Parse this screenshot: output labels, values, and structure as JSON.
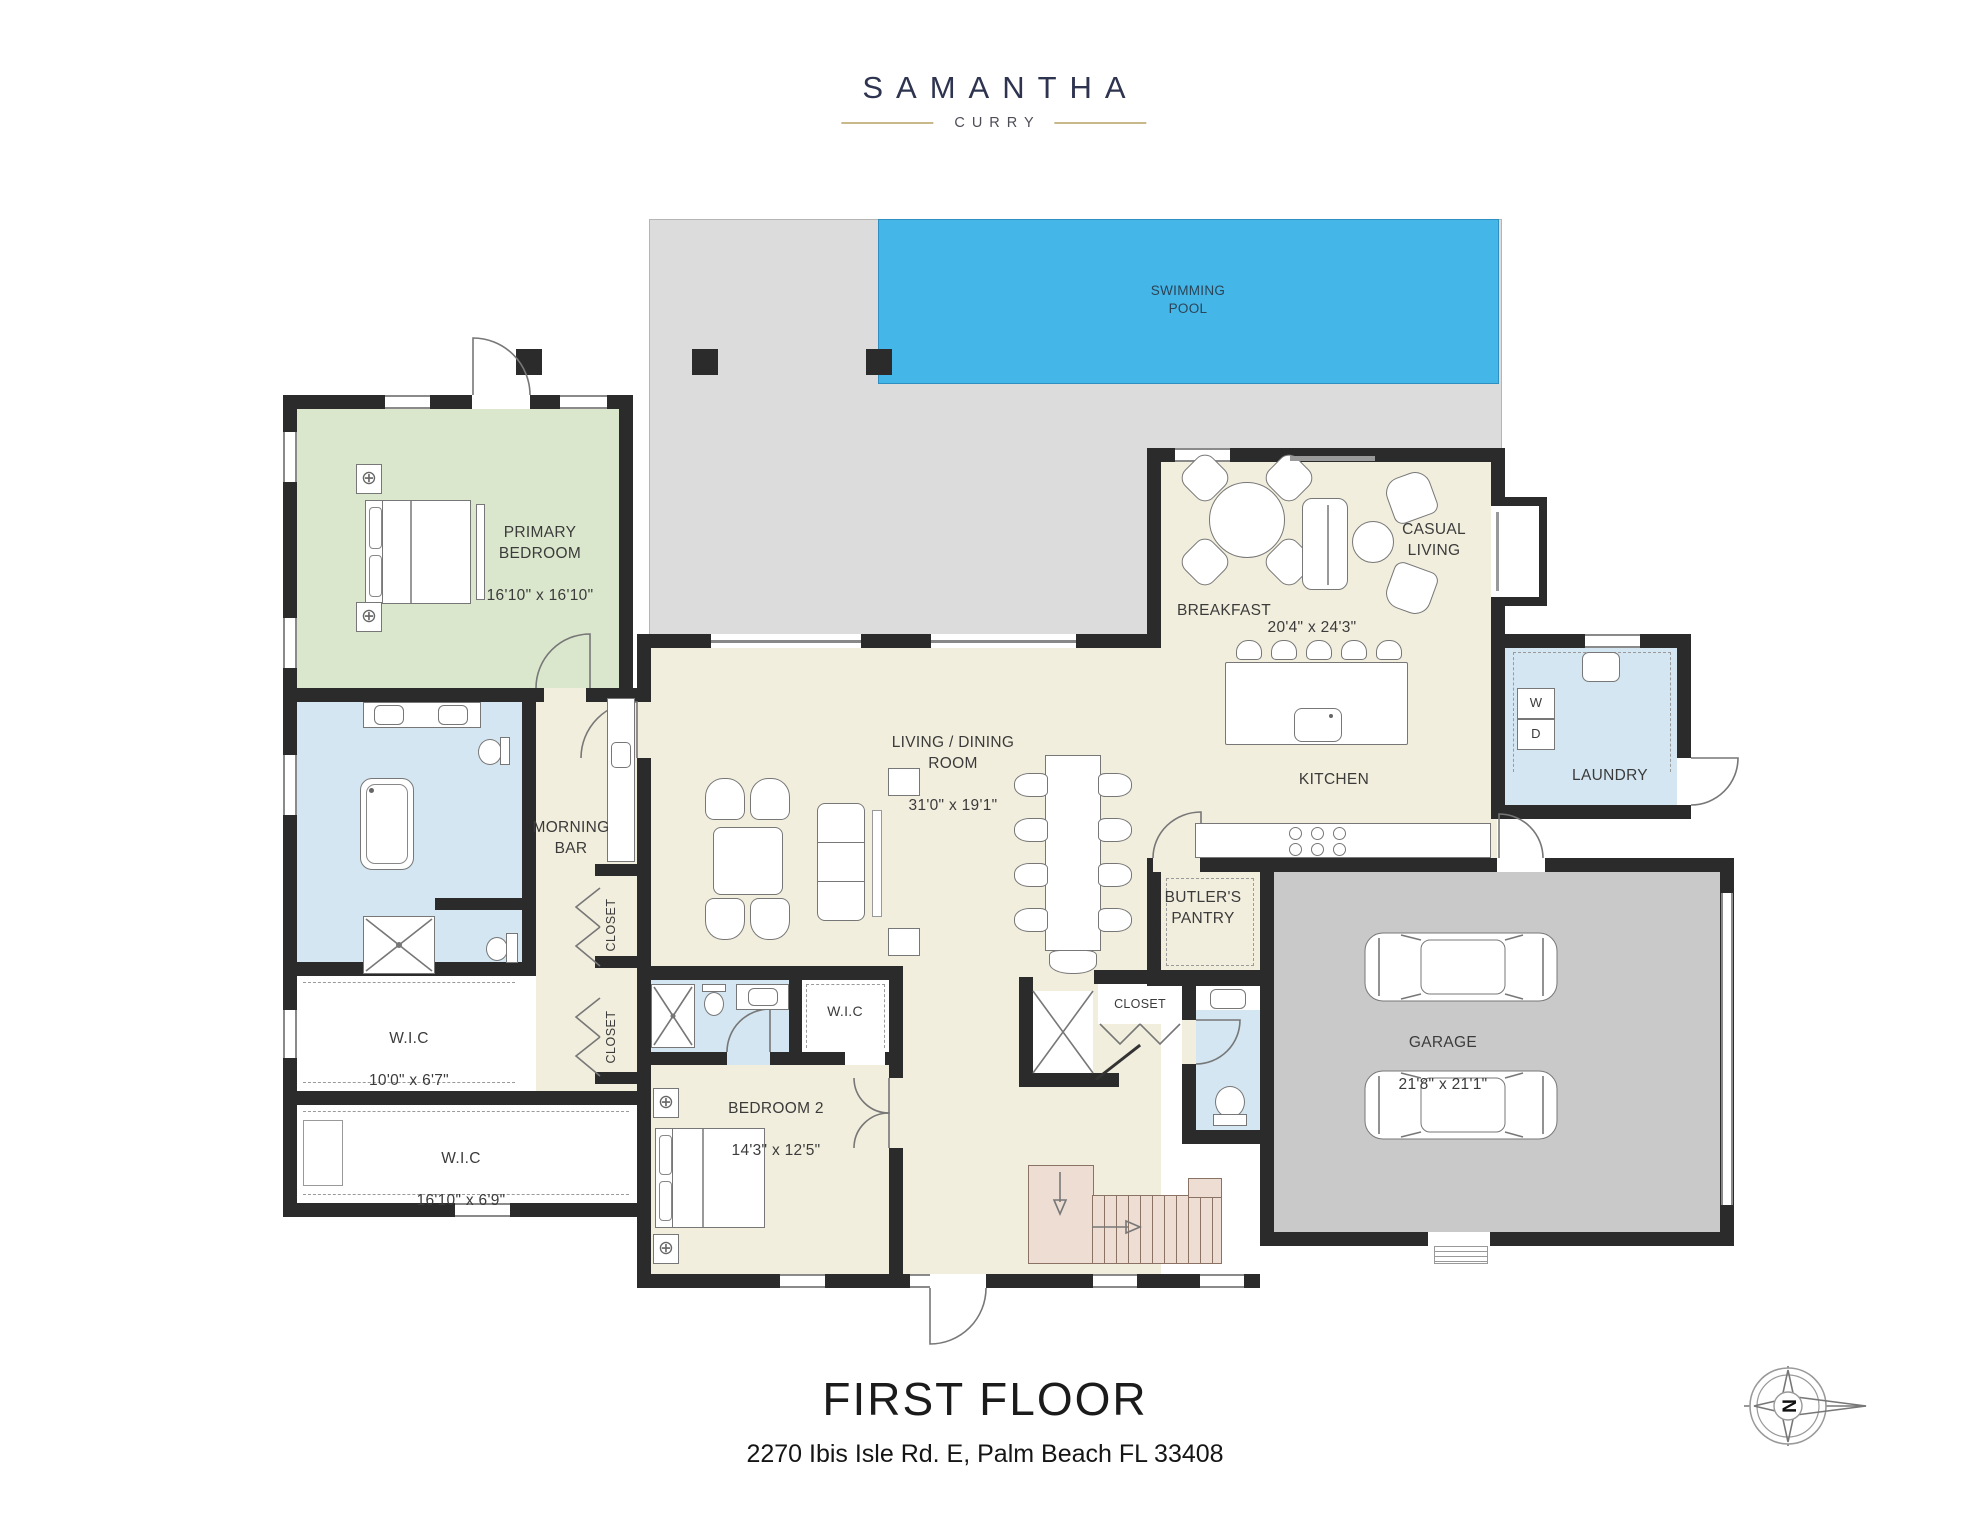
{
  "brand": {
    "name": "SAMANTHA",
    "sub": "CURRY"
  },
  "plan": {
    "pool": {
      "label": "SWIMMING\nPOOL"
    },
    "primary_bedroom": {
      "name": "PRIMARY\nBEDROOM",
      "dims": "16'10\" x 16'10\""
    },
    "casual_living": {
      "name": "CASUAL\nLIVING"
    },
    "breakfast": {
      "name": "BREAKFAST",
      "dims": "20'4\" x 24'3\""
    },
    "living_dining": {
      "name": "LIVING / DINING\nROOM",
      "dims": "31'0\" x 19'1\""
    },
    "morning_bar": {
      "name": "MORNING\nBAR"
    },
    "kitchen": {
      "name": "KITCHEN"
    },
    "laundry": {
      "name": "LAUNDRY",
      "washer": "W",
      "dryer": "D"
    },
    "butlers_pantry": {
      "name": "BUTLER'S\nPANTRY"
    },
    "stair_closet": {
      "name": "CLOSET"
    },
    "hall_closet_upper": {
      "name": "CLOSET"
    },
    "hall_closet_lower": {
      "name": "CLOSET"
    },
    "wic_primary_small": {
      "name": "W.I.C",
      "dims": "10'0\" x 6'7\""
    },
    "wic_primary_large": {
      "name": "W.I.C",
      "dims": "16'10\" x 6'9\""
    },
    "wic_bedroom2": {
      "name": "W.I.C"
    },
    "bedroom2": {
      "name": "BEDROOM 2",
      "dims": "14'3\" x 12'5\""
    },
    "garage": {
      "name": "GARAGE",
      "dims": "21'8\" x 21'1\""
    }
  },
  "compass": {
    "north": "N"
  },
  "footer": {
    "title": "FIRST FLOOR",
    "address": "2270 Ibis Isle Rd. E, Palm Beach FL 33408"
  },
  "colors": {
    "wall": "#2b2b2b",
    "pool": "#44b6e8",
    "deck": "#dcdcdc",
    "garage_floor": "#c9c9c9",
    "bedroom_green": "#dbe7cd",
    "bath_blue": "#d3e6f1",
    "cream": "#f2eedd",
    "stairs_pink": "#eeddd3",
    "logo_navy": "#2e3450",
    "logo_gold": "#c9b98a"
  }
}
